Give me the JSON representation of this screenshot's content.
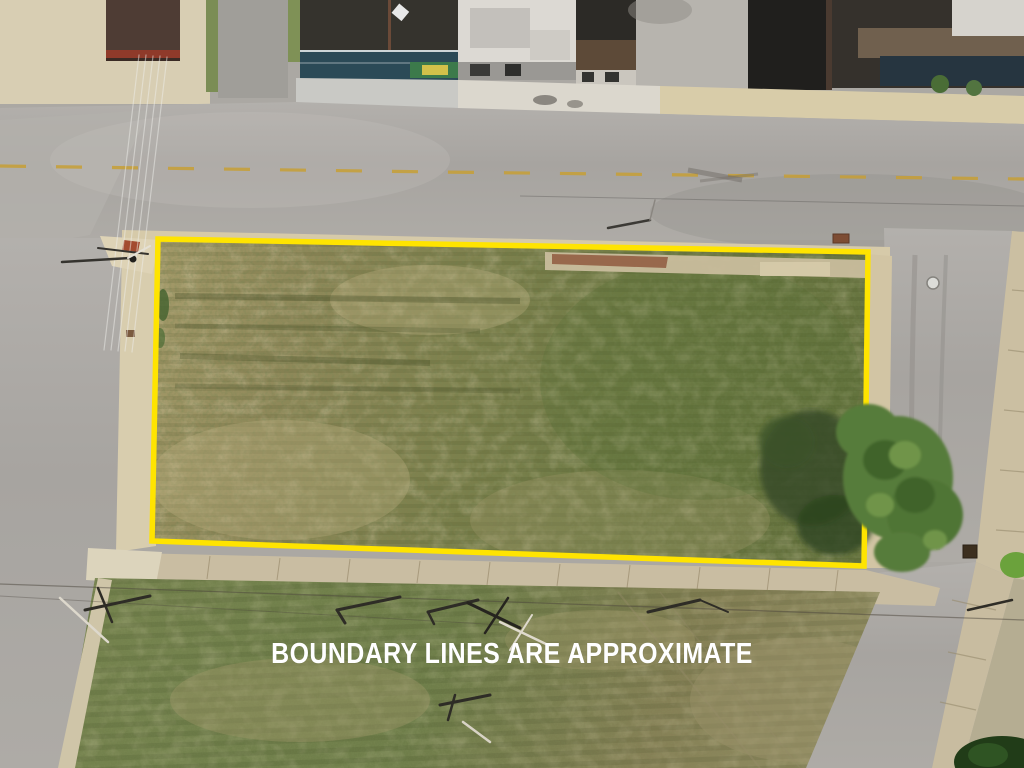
{
  "overlay": {
    "disclaimer_text": "BOUNDARY LINES ARE APPROXIMATE",
    "disclaimer_color": "#ffffff",
    "boundary_color": "#ffe400",
    "boundary_points": "158,239 868,252 864,566 152,541"
  },
  "palette": {
    "asphalt_road": "#a9a6a1",
    "concrete_sidewalk": "#d6caa9",
    "lot_grass_dry": "#a59b6a",
    "lot_grass_green": "#6d7943",
    "bottom_field_grass": "#6e7d49",
    "tree_canopy": "#567c3a",
    "curb_ramp_pad": "#a34b2f",
    "road_center_line": "#c79f35"
  }
}
